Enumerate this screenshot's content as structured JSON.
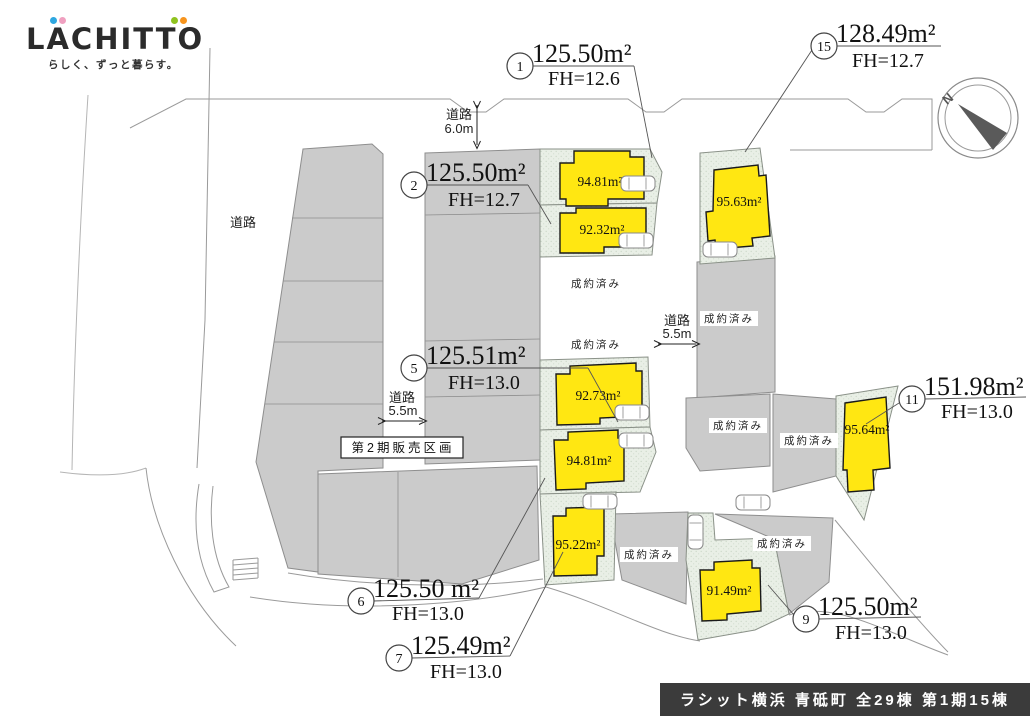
{
  "logo": {
    "text": "LACHITTO",
    "tagline": "らしく、ずっと暮らす。"
  },
  "compass": {
    "north": "N"
  },
  "plan": {
    "sold_label": "成約済み",
    "phase2_label": "第2期販売区画",
    "road": "道路",
    "road_width_top": "6.0m",
    "road_width_center": "5.5m",
    "road_width_west": "5.5m"
  },
  "annotations": [
    {
      "num": "1",
      "area": "125.50m²",
      "fh": "FH=12.6"
    },
    {
      "num": "2",
      "area": "125.50m²",
      "fh": "FH=12.7"
    },
    {
      "num": "5",
      "area": "125.51m²",
      "fh": "FH=13.0"
    },
    {
      "num": "6",
      "area": "125.50 m²",
      "fh": "FH=13.0"
    },
    {
      "num": "7",
      "area": "125.49m²",
      "fh": "FH=13.0"
    },
    {
      "num": "9",
      "area": "125.50m²",
      "fh": "FH=13.0"
    },
    {
      "num": "11",
      "area": "151.98m²",
      "fh": "FH=13.0"
    },
    {
      "num": "15",
      "area": "128.49m²",
      "fh": "FH=12.7"
    }
  ],
  "buildings": [
    {
      "area": "94.81m²"
    },
    {
      "area": "92.32m²"
    },
    {
      "area": "95.63m²"
    },
    {
      "area": "92.73m²"
    },
    {
      "area": "94.81m²"
    },
    {
      "area": "95.22m²"
    },
    {
      "area": "95.64m²"
    },
    {
      "area": "91.49m²"
    }
  ],
  "footer": {
    "banner": "ラシット横浜 青砥町 全29棟 第1期15棟"
  },
  "colors": {
    "building": "#FFE712",
    "sold_lot": "#CBCBCB",
    "sale_lot": "#E9EFE6",
    "footer_bg": "#3B3B3B"
  }
}
